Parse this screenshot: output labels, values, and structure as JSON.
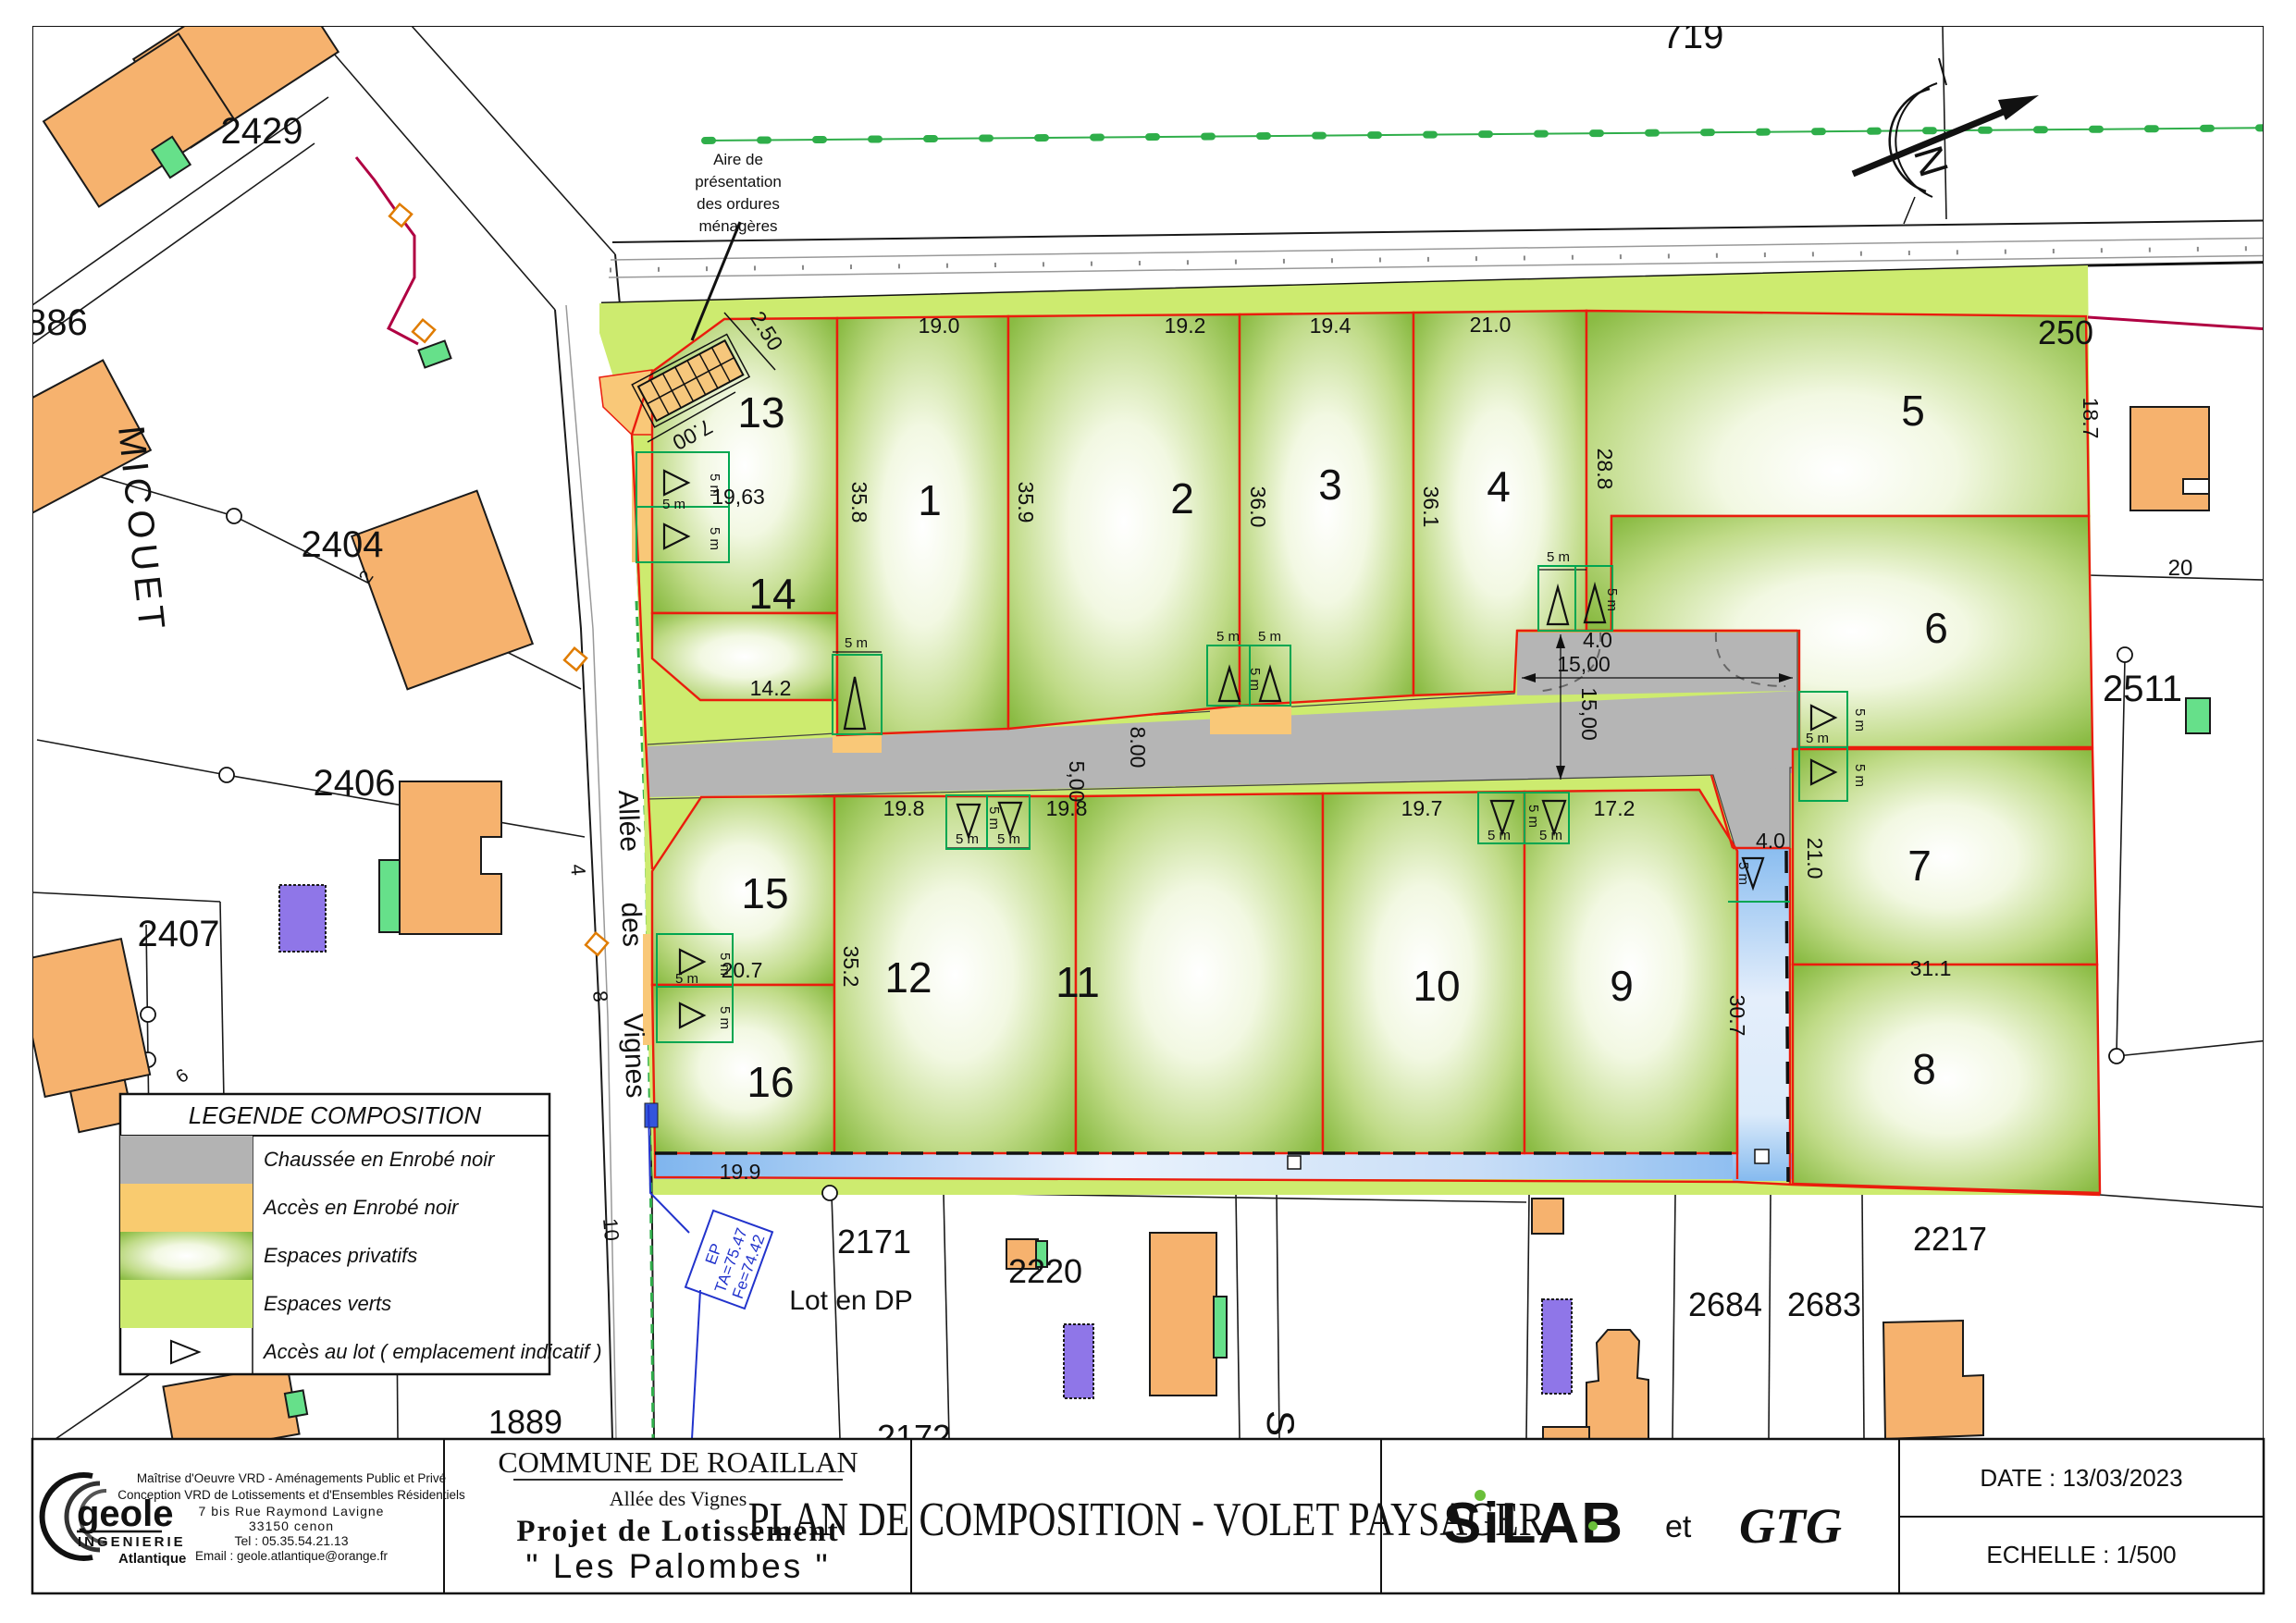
{
  "title_block": {
    "firm": {
      "name": "geole",
      "subname": "INGENIERIE",
      "region": "Atlantique",
      "lines": [
        "Maîtrise d'Oeuvre VRD - Aménagements Public et Privé",
        "Conception VRD de Lotissements et d'Ensembles Résidentiels",
        "7 bis Rue Raymond Lavigne",
        "33150 cenon",
        "Tel : 05.35.54.21.13",
        "Email : geole.atlantique@orange.fr"
      ]
    },
    "commune": {
      "line1": "COMMUNE DE ROAILLAN",
      "line2": "Allée des Vignes",
      "line3": "Projet de Lotissement",
      "line4": "\" Les Palombes \""
    },
    "plan_title": "PLAN DE COMPOSITION - VOLET PAYSAGER",
    "partners": {
      "logo1": "SiLAB",
      "conj": "et",
      "logo2": "GTG"
    },
    "date_label": "DATE : 13/03/2023",
    "scale_label": "ECHELLE : 1/500"
  },
  "legend": {
    "title": "LEGENDE COMPOSITION",
    "items": [
      {
        "label": "Chaussée en Enrobé noir",
        "swatch": "#b3b3b3"
      },
      {
        "label": "Accès en Enrobé noir",
        "swatch": "#f9cb6f"
      },
      {
        "label": "Espaces privatifs",
        "swatch": "gradient-green"
      },
      {
        "label": "Espaces verts",
        "swatch": "#cdeb6f"
      },
      {
        "label": "Accès au lot ( emplacement indicatif )",
        "swatch": "triangle-icon"
      }
    ]
  },
  "annotations": {
    "bins": [
      "Aire de",
      "présentation",
      "des ordures",
      "ménagères"
    ],
    "lot_dp": "Lot en DP",
    "ep": [
      "EP",
      "TA=75.47",
      "Fe=74.42"
    ],
    "north": "N"
  },
  "streets": {
    "micouet": "MICOUET",
    "allee": [
      "Allée",
      "des",
      "Vignes"
    ],
    "s": "S",
    "numbers": [
      "2",
      "4",
      "8",
      "10",
      "6"
    ]
  },
  "parcels": {
    "p719": "719",
    "p2429": "2429",
    "p886": "886",
    "p2404": "2404",
    "p2406": "2406",
    "p2407": "2407",
    "p1889": "1889",
    "p2171": "2171",
    "p2220": "2220",
    "p2172": "2172",
    "p2684": "2684",
    "p2683": "2683",
    "p2217": "2217",
    "p2511": "2511",
    "p250": "250",
    "p20": "20"
  },
  "lots": {
    "l1": "1",
    "l2": "2",
    "l3": "3",
    "l4": "4",
    "l5": "5",
    "l6": "6",
    "l7": "7",
    "l8": "8",
    "l9": "9",
    "l10": "10",
    "l11": "11",
    "l12": "12",
    "l13": "13",
    "l14": "14",
    "l15": "15",
    "l16": "16"
  },
  "dims": {
    "d19_0": "19.0",
    "d19_2": "19.2",
    "d19_4": "19.4",
    "d21_0": "21.0",
    "d18_7": "18.7",
    "d28_8": "28.8",
    "d35_8": "35.8",
    "d35_9": "35.9",
    "d36_0": "36.0",
    "d36_1": "36.1",
    "d19_63": "19,63",
    "d14_2": "14.2",
    "d2_50": "2.50",
    "d7_00": "7.00",
    "d8_00": "8.00",
    "d5_00": "5,00",
    "d15_00h": "15,00",
    "d15_00v": "15,00",
    "d4_0a": "4.0",
    "d4_0b": "4.0",
    "d21_0b": "21.0",
    "d31_1": "31.1",
    "d30_7": "30.7",
    "d19_8a": "19.8",
    "d19_8b": "19.8",
    "d19_7": "19.7",
    "d17_2": "17.2",
    "d35_2": "35.2",
    "d20_7": "20.7",
    "d19_9": "19.9",
    "five_m": "5 m"
  },
  "colors": {
    "lot_line_red": "#ea1c0d",
    "perimeter_crimson": "#b00042",
    "espaces_verts": "#cdeb6f",
    "acces_orange": "#f9c878",
    "chaussee_gray": "#b5b5b5",
    "palombes_cyan": "#29abe2",
    "hedge_green": "#2fae4a",
    "water_blue": "#7fb5ee"
  }
}
